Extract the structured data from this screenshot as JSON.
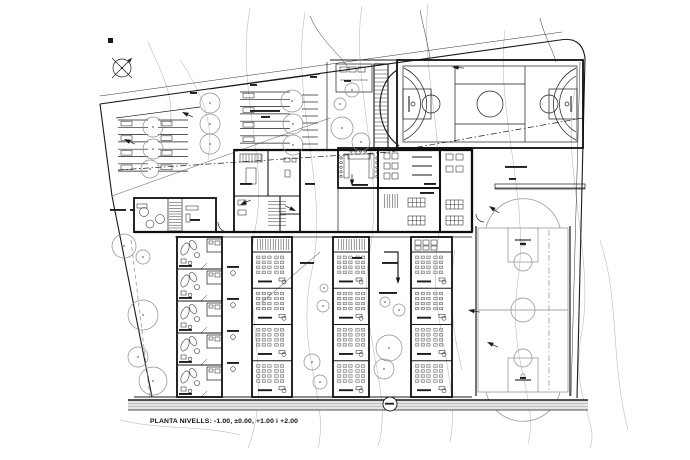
{
  "caption": {
    "text": "PLANTA NIVELLS: -1.00, ±0.00, +1.00 i +2.00"
  },
  "colors": {
    "background": "#ffffff",
    "ink": "#1a1a1a",
    "wall": "#0e0e0e",
    "light": "#8d8d8d",
    "contour": "#bcbcbc",
    "court_light": "#a4a4a4",
    "road_fill": "#e4e4e4"
  },
  "legend": {
    "drawing_type": "architectural site / floor plan",
    "areas": [
      "parking rows with trees (north-west)",
      "multi-sport court (north-east)",
      "administration block with meeting room (centre)",
      "five classroom wings with desk grids (south)",
      "practice basketball court (south-east)",
      "tree courtyards",
      "perimeter road band (south)"
    ]
  }
}
